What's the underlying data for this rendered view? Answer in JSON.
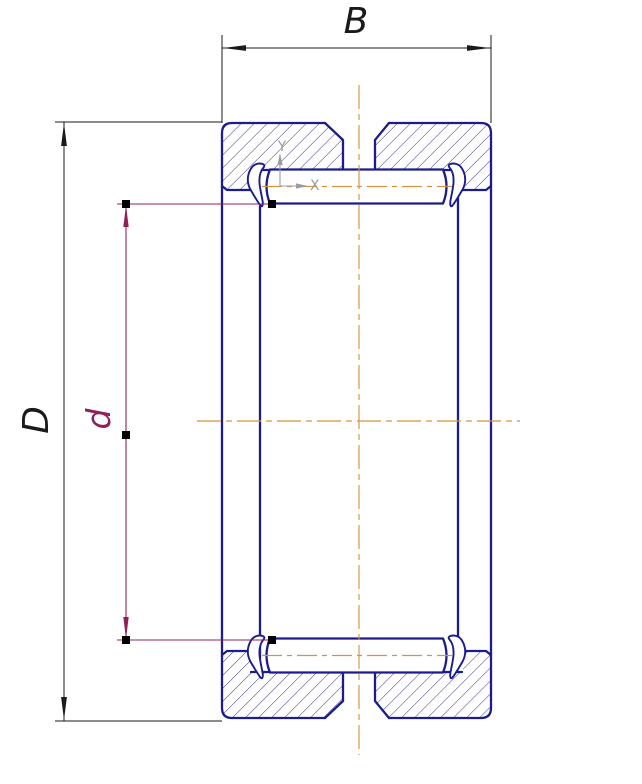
{
  "drawing": {
    "labels": {
      "width": "B",
      "outer_diameter": "D",
      "inner_diameter": "d",
      "axis_x": "X",
      "axis_y": "Y"
    },
    "colors": {
      "body": "#1c1c8e",
      "hatch": "#33337a",
      "centerline": "#d2953f",
      "dimension": "#1a1a1a",
      "selected_dimension": "#8f2158",
      "axes": "#9c9c9c",
      "handle": "#000000",
      "background": "#ffffff"
    }
  }
}
